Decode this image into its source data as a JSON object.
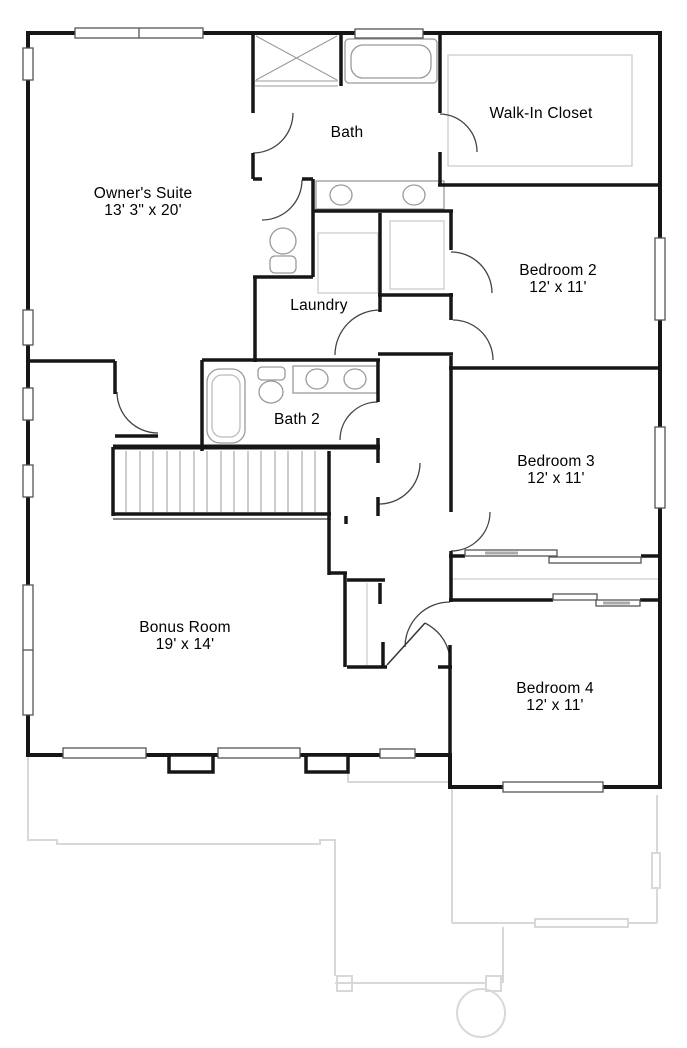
{
  "plan": {
    "title": "Second Floor Plan",
    "wall_color": "#161616",
    "fixture_color": "#9a9a9a",
    "faint_color": "#d8d8d8",
    "rooms": [
      {
        "id": "owners-suite",
        "name": "Owner's Suite",
        "dims": "13' 3\" x 20'"
      },
      {
        "id": "bath",
        "name": "Bath",
        "dims": ""
      },
      {
        "id": "walk-in-closet",
        "name": "Walk-In Closet",
        "dims": ""
      },
      {
        "id": "bedroom-2",
        "name": "Bedroom 2",
        "dims": "12' x 11'"
      },
      {
        "id": "laundry",
        "name": "Laundry",
        "dims": ""
      },
      {
        "id": "bath-2",
        "name": "Bath 2",
        "dims": ""
      },
      {
        "id": "bedroom-3",
        "name": "Bedroom 3",
        "dims": "12' x 11'"
      },
      {
        "id": "bonus-room",
        "name": "Bonus Room",
        "dims": "19' x 14'"
      },
      {
        "id": "bedroom-4",
        "name": "Bedroom 4",
        "dims": "12' x 11'"
      }
    ]
  }
}
